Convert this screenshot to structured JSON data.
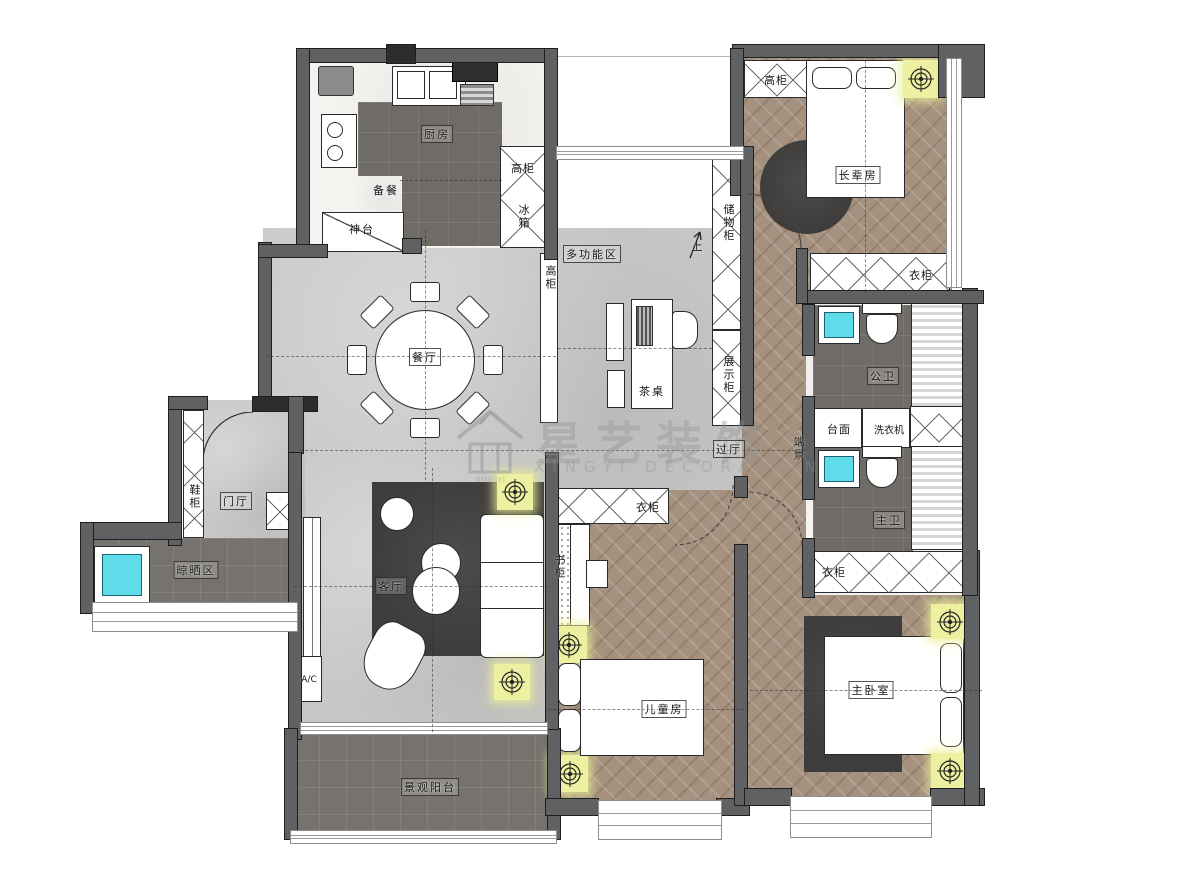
{
  "watermark": {
    "cn": "星艺装饰",
    "en": "XINGYI DECORATION"
  },
  "rooms": {
    "kitchen": "厨房",
    "dining": "餐厅",
    "multifunction": "多功能区",
    "elder": "长辈房",
    "public_bath": "公卫",
    "master_bath": "主卫",
    "entry": "门厅",
    "drying": "晾晒区",
    "living": "客厅",
    "children": "儿童房",
    "master": "主卧室",
    "balcony": "景观阳台",
    "passage": "过厅"
  },
  "fixtures": {
    "prep": "备餐",
    "altar": "神台",
    "kitchen_tall_cabinet": "高柜",
    "fridge": "冰箱",
    "up": "上",
    "storage_cabinet": "储物柜",
    "display_cabinet": "展示柜",
    "tea_table": "茶桌",
    "corridor_tall_cabinet": "高柜",
    "elder_tall_cabinet": "高柜",
    "elder_wardrobe": "衣柜",
    "counter": "台面",
    "washer": "洗衣机",
    "end_view": "端景",
    "shoe_cabinet": "鞋柜",
    "ac": "A/C",
    "children_wardrobe": "衣柜",
    "bookcase": "书柜",
    "master_wardrobe": "衣柜"
  },
  "colors": {
    "wall": "#5f6163",
    "concrete_floor": "#c7c7c5",
    "dark_tile_floor": "#6f6b66",
    "wood_floor": "#a5917f",
    "marble_floor": "#f4f3f0",
    "sink_basin": "#5fdbe9",
    "ceiling_light": "#edf0a0",
    "rug": "#3f3d3b"
  }
}
